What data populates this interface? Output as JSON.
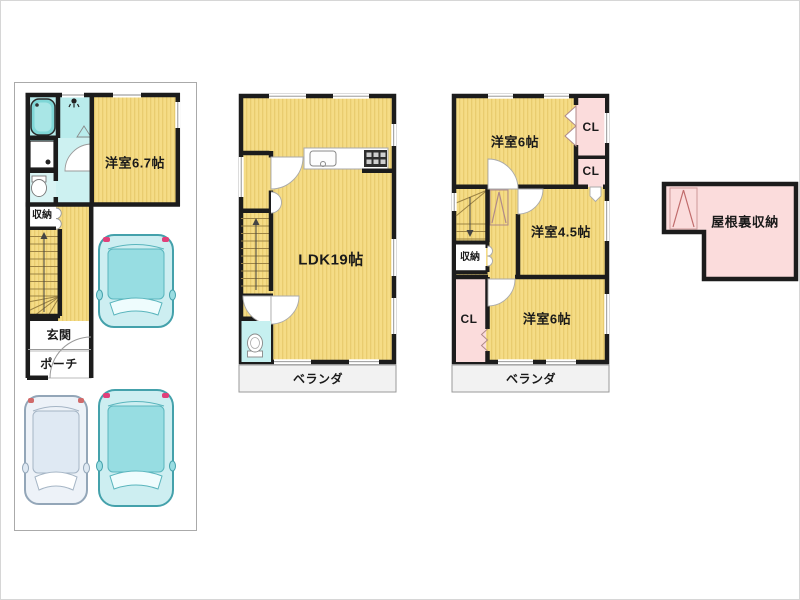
{
  "plan_title": "3-story house floor plan with attic",
  "floor1": {
    "bedroom": "洋室6.7帖",
    "storage": "収納",
    "entrance": "玄関",
    "porch": "ポーチ"
  },
  "floor2": {
    "ldk": "LDK19帖",
    "veranda": "ベランダ"
  },
  "floor3": {
    "bedroom_top": "洋室6帖",
    "closet_top": "CL",
    "closet_mid": "CL",
    "bedroom_mid": "洋室4.5帖",
    "storage": "収納",
    "closet_left": "CL",
    "bedroom_bottom": "洋室6帖",
    "veranda": "ベランダ"
  },
  "attic": {
    "label": "屋根裏収納"
  },
  "colors": {
    "room_yellow": "#f5dc86",
    "room_stripe": "#e9cc6f",
    "closet_pink": "#fbdcdc",
    "wet_cyan": "#b9ecec",
    "wall_black": "#1c1c1c",
    "veranda_gray": "#f2f2f2",
    "car_teal": "#cdeef1",
    "car_outline": "#44a1ab"
  }
}
